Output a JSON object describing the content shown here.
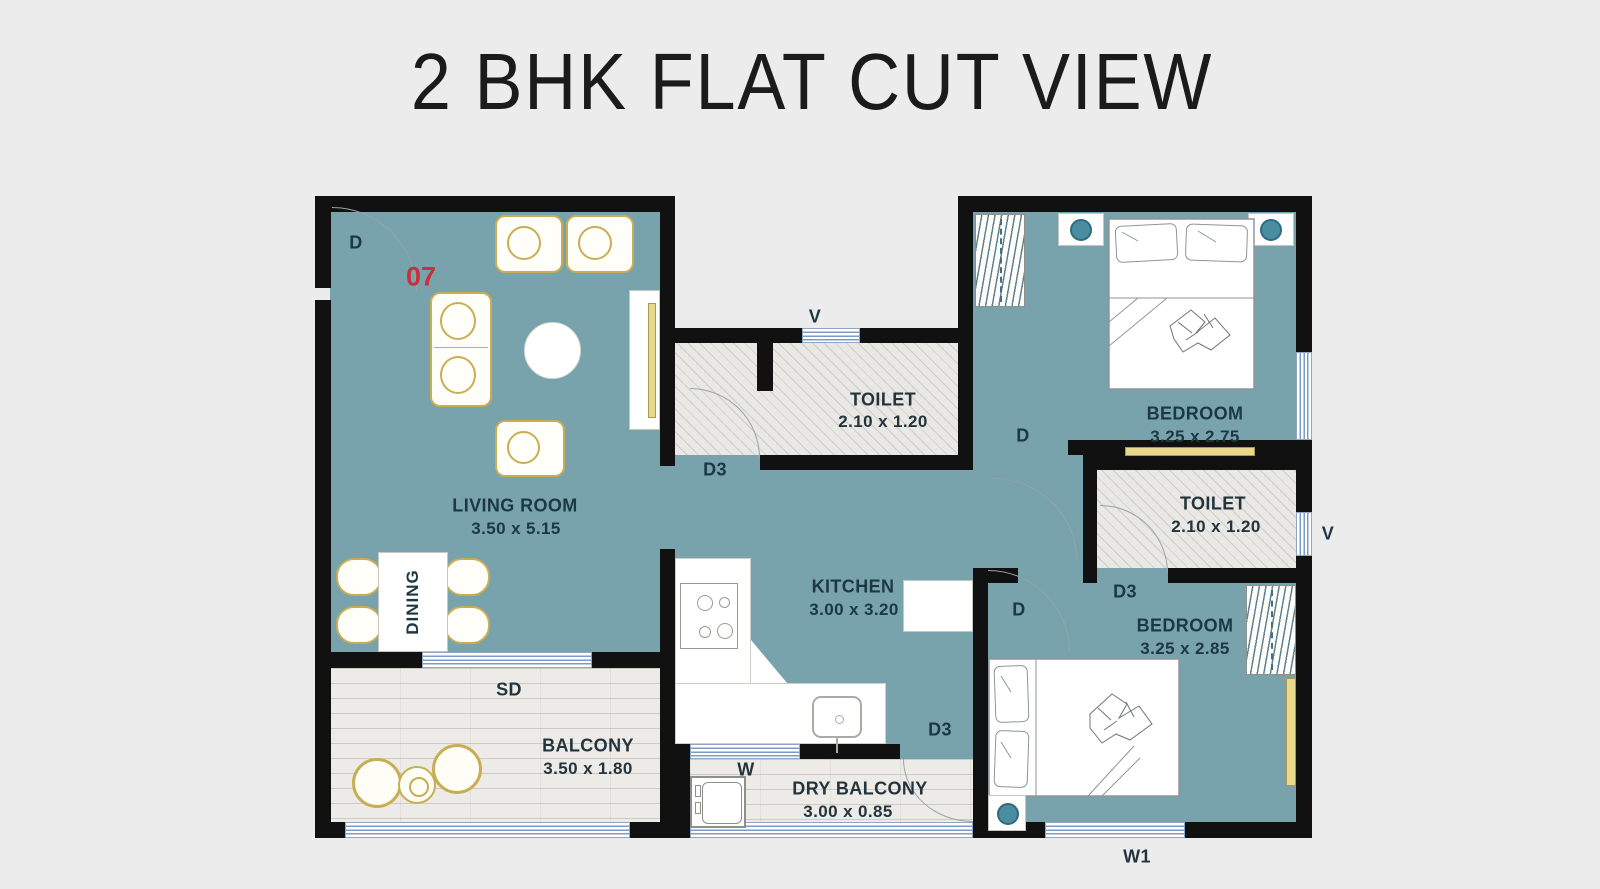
{
  "title": "2 BHK FLAT CUT VIEW",
  "unit_number": "07",
  "colors": {
    "background": "#ececec",
    "room_fill": "#78a3ad",
    "wall": "#111111",
    "floor_light": "#e9e8e4",
    "window_blue": "#7b9cc9",
    "furniture_gold": "#c9ad52",
    "lamp_teal": "#4a8da0",
    "label_text": "#1c3844",
    "unit_number_red": "#c8303c"
  },
  "rooms": {
    "living": {
      "name": "LIVING ROOM",
      "dims": "3.50 x 5.15"
    },
    "dining": {
      "name": "DINING"
    },
    "toilet_top": {
      "name": "TOILET",
      "dims": "2.10 x 1.20"
    },
    "bedroom_top": {
      "name": "BEDROOM",
      "dims": "3.25 x 2.75"
    },
    "toilet_right": {
      "name": "TOILET",
      "dims": "2.10 x 1.20"
    },
    "bedroom_bottom": {
      "name": "BEDROOM",
      "dims": "3.25 x 2.85"
    },
    "kitchen": {
      "name": "KITCHEN",
      "dims": "3.00 x 3.20"
    },
    "balcony": {
      "name": "BALCONY",
      "dims": "3.50 x 1.80"
    },
    "dry_balcony": {
      "name": "DRY BALCONY",
      "dims": "3.00 x 0.85"
    }
  },
  "openings": {
    "main_door": "D",
    "toilet_top_door": "D3",
    "toilet_top_vent": "V",
    "bedroom_top_door": "D",
    "toilet_right_door": "D3",
    "toilet_right_vent": "V",
    "bedroom_bottom_door": "D",
    "dry_balcony_door": "D3",
    "sliding_door": "SD",
    "kitchen_window": "W",
    "bedroom_bottom_window": "W1"
  }
}
